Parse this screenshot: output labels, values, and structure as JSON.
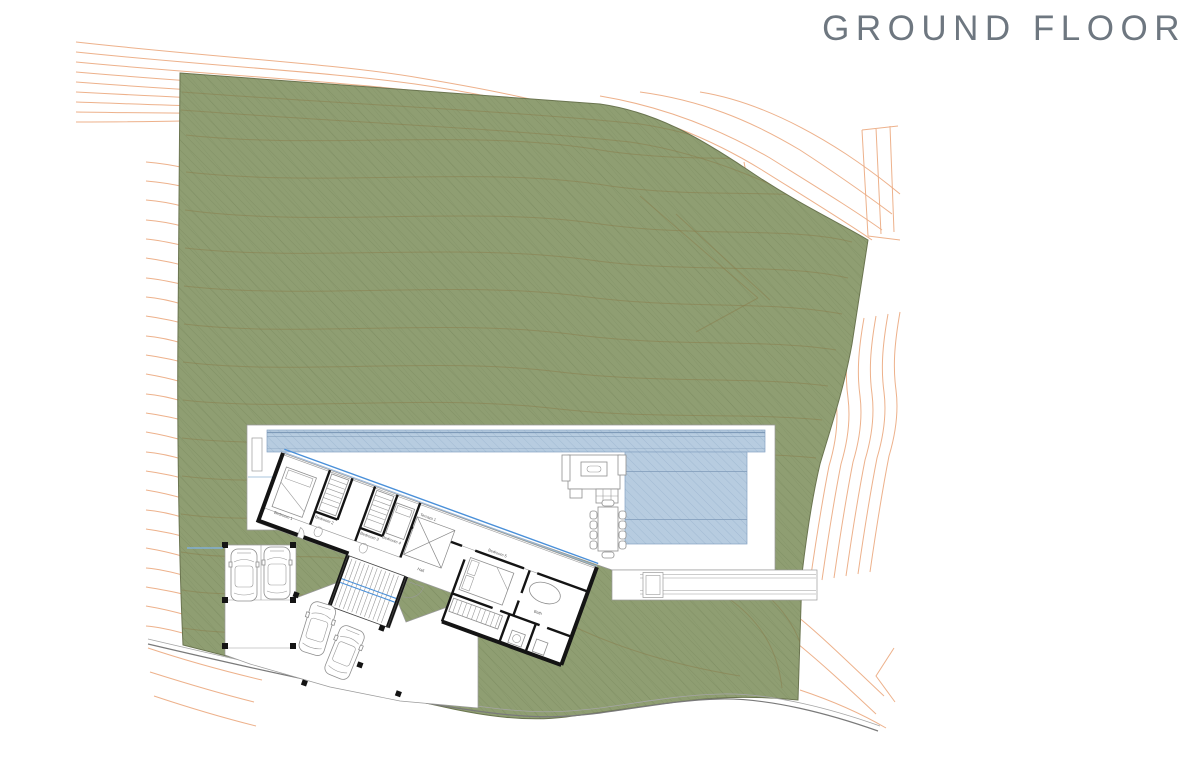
{
  "title": "GROUND FLOOR",
  "colors": {
    "site_green": "#8F9E72",
    "hatch_green": "#5F7040",
    "contour_inner": "#8A7C4A",
    "contour_orange": "#EBA87E",
    "pool_blue": "#B7CCE0",
    "pool_line": "#7E9AB8",
    "accent_blue": "#4A90D9",
    "wall_black": "#141414",
    "road_gray": "#7A7A7A",
    "title_gray": "#6E7780",
    "line_gray": "#9A9A9A"
  },
  "plan": {
    "rotation_deg": 20,
    "rooms": [
      {
        "label": "Bedroom 1"
      },
      {
        "label": "Bedroom 2"
      },
      {
        "label": "Bedroom 3"
      },
      {
        "label": "Bedroom 4"
      },
      {
        "label": "Hall"
      },
      {
        "label": "Terraza 1"
      },
      {
        "label": "Bedroom 5"
      },
      {
        "label": "Bath"
      }
    ]
  },
  "site": {
    "vehicles": 4,
    "carport_spaces": 2,
    "elements": [
      "site-boundary",
      "terrain-contours",
      "access-road",
      "terrace",
      "swimming-pool",
      "lap-pool",
      "walkway",
      "planter",
      "outdoor-dining-table",
      "outdoor-lounge",
      "carport",
      "staircase"
    ]
  }
}
